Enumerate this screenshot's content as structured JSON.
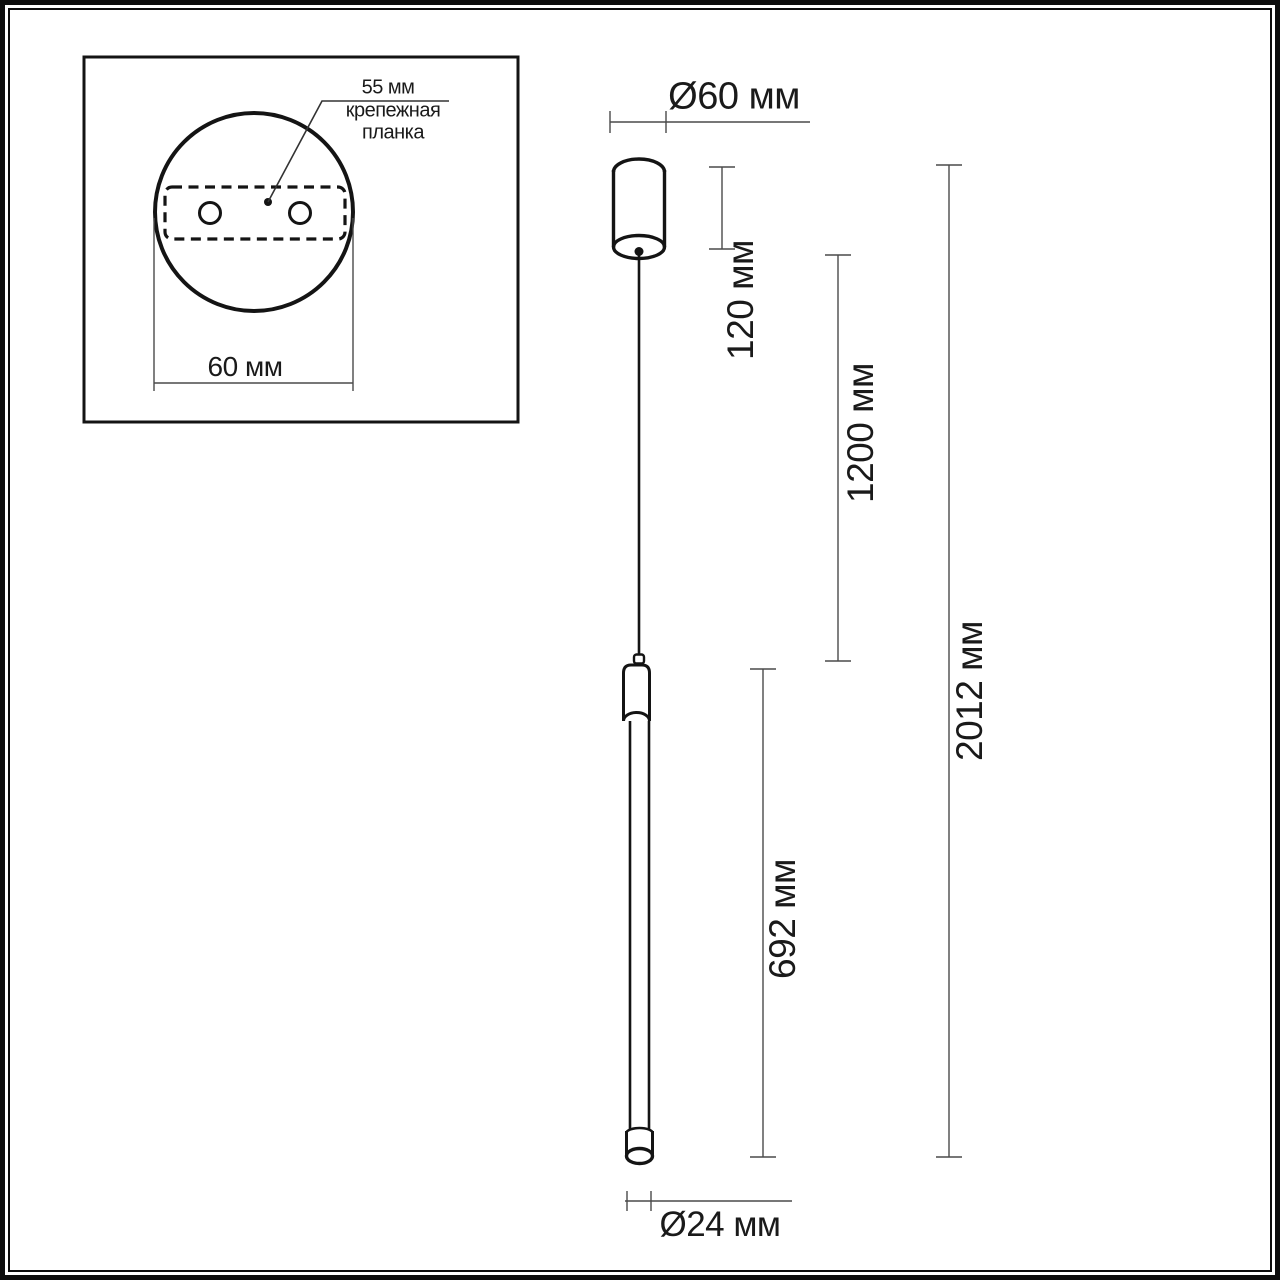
{
  "drawing_title": "pendant-lamp-dimension-drawing",
  "inset": {
    "bar_spacing_label": "55 мм",
    "part_label_line1": "крепежная",
    "part_label_line2": "планка",
    "base_width_label": "60 мм"
  },
  "dimensions": {
    "canopy_diameter": "Ø60 мм",
    "canopy_height": "120 мм",
    "cable_length": "1200 мм",
    "total_height": "2012 мм",
    "tube_length": "692 мм",
    "tube_diameter": "Ø24 мм"
  },
  "colors": {
    "outline": "#141414",
    "dimension_line": "#4a4a4a",
    "background": "#ffffff",
    "text": "#1a1a1a"
  }
}
